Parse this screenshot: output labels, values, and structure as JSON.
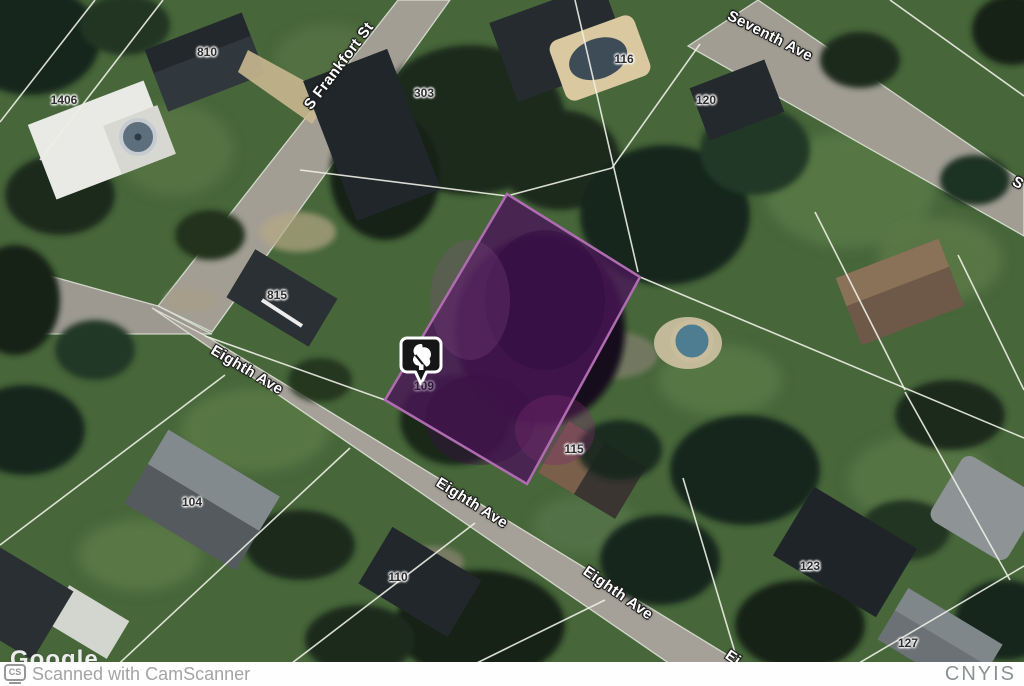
{
  "map": {
    "type": "satellite",
    "street_labels": [
      {
        "name": "s-frankfort-st",
        "text": "S Frankfort St"
      },
      {
        "name": "seventh-ave",
        "text": "Seventh Ave"
      },
      {
        "name": "eighth-ave-upper",
        "text": "Eighth Ave"
      },
      {
        "name": "eighth-ave-middle",
        "text": "Eighth Ave"
      },
      {
        "name": "eighth-ave-lower",
        "text": "Eighth Ave"
      },
      {
        "name": "eighth-ave-partial-bottom",
        "text": "Ei"
      },
      {
        "name": "street-partial-right-edge",
        "text": "S"
      }
    ],
    "house_numbers": [
      {
        "value": "810"
      },
      {
        "value": "1406"
      },
      {
        "value": "303"
      },
      {
        "value": "116"
      },
      {
        "value": "120"
      },
      {
        "value": "815"
      },
      {
        "value": "115"
      },
      {
        "value": "109"
      },
      {
        "value": "104"
      },
      {
        "value": "110"
      },
      {
        "value": "123"
      },
      {
        "value": "127"
      }
    ],
    "highlighted_parcel": {
      "fill_color": "#4a1758",
      "border_color": "#b06cb0"
    },
    "marker": {
      "icon": "tree-icon",
      "fill_color": "#161616",
      "border_color": "#ffffff"
    }
  },
  "footer": {
    "badge": "CS",
    "scanner_text": "Scanned with CamScanner",
    "google_watermark": "Google",
    "right_watermark": "CNYIS"
  }
}
